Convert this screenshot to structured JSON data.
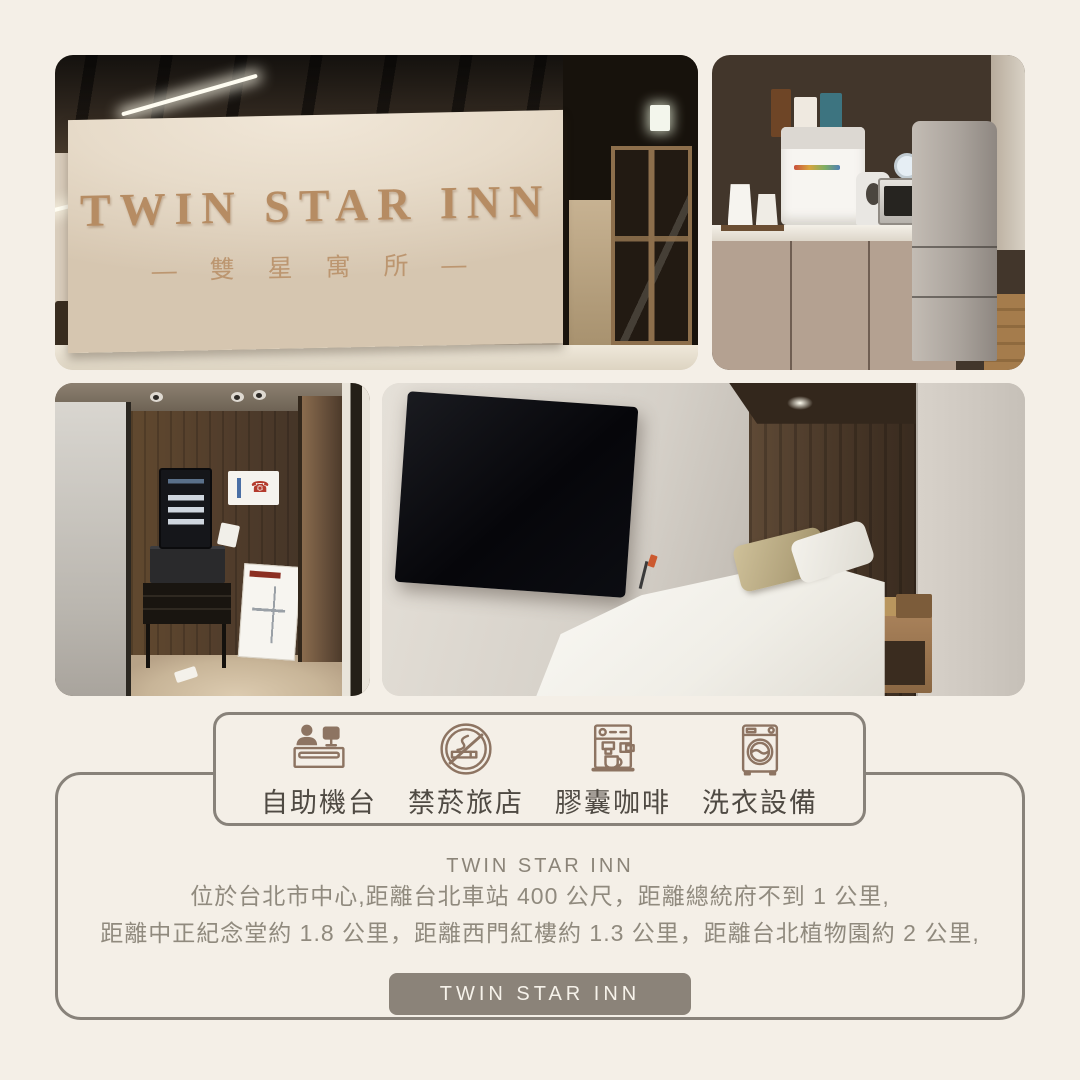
{
  "page": {
    "background_color": "#f4efe7",
    "frame_border_color": "#88827a"
  },
  "photos": {
    "lobby": {
      "sign_title": "TWIN STAR INN",
      "sign_subtitle": "— 雙 星 寓 所 —"
    }
  },
  "features": {
    "icon_color": "#8d7462",
    "label_color": "#4f4a43",
    "items": [
      {
        "icon": "reception-kiosk-icon",
        "label": "自助機台"
      },
      {
        "icon": "no-smoking-icon",
        "label": "禁菸旅店"
      },
      {
        "icon": "coffee-machine-icon",
        "label": "膠囊咖啡"
      },
      {
        "icon": "washing-machine-icon",
        "label": "洗衣設備"
      }
    ]
  },
  "description": {
    "title": "TWIN STAR INN",
    "lines": [
      "位於台北市中心,距離台北車站 400 公尺，距離總統府不到 1 公里,",
      "距離中正紀念堂約 1.8 公里，距離西門紅樓約 1.3 公里，距離台北植物園約 2 公里,"
    ]
  },
  "footer_button": {
    "label": "TWIN STAR INN",
    "background_color": "#8b8379",
    "text_color": "#f6f2ea"
  }
}
